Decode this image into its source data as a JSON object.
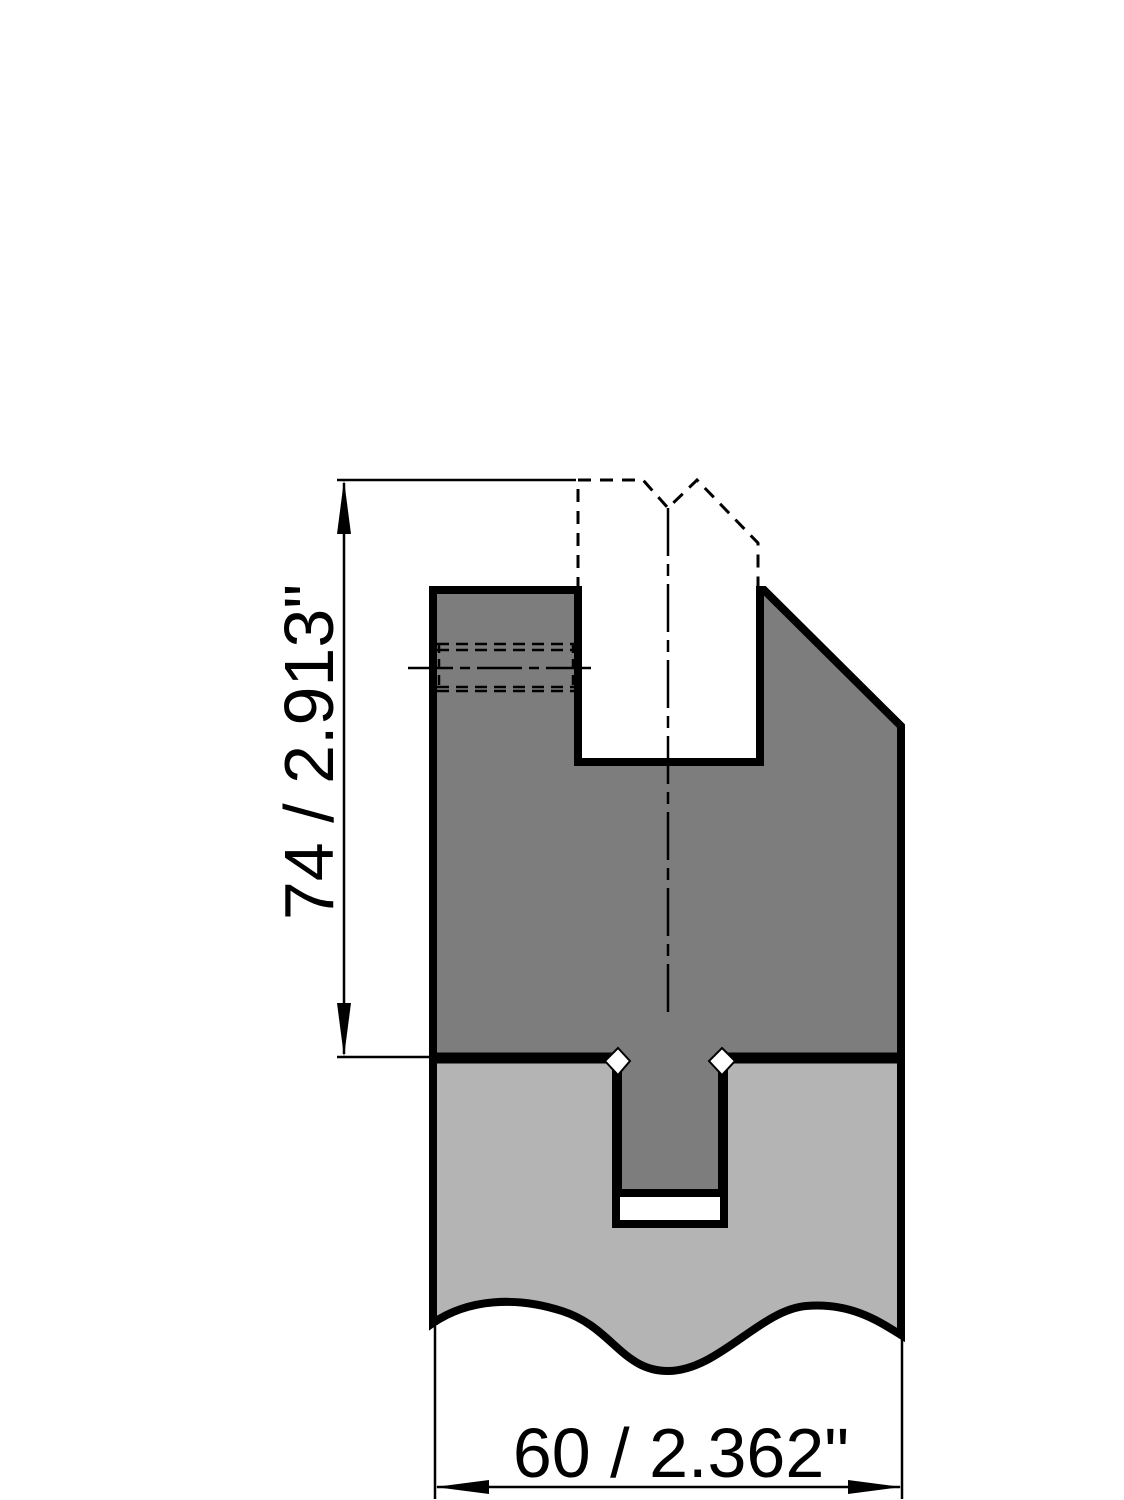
{
  "drawing": {
    "dimension_height": {
      "label": "74 / 2.913\""
    },
    "dimension_width": {
      "label": "60 / 2.362\""
    },
    "colors": {
      "upper_part": "#7d7d7d",
      "lower_part": "#b4b4b4",
      "outline": "#000000",
      "background": "#ffffff"
    }
  }
}
